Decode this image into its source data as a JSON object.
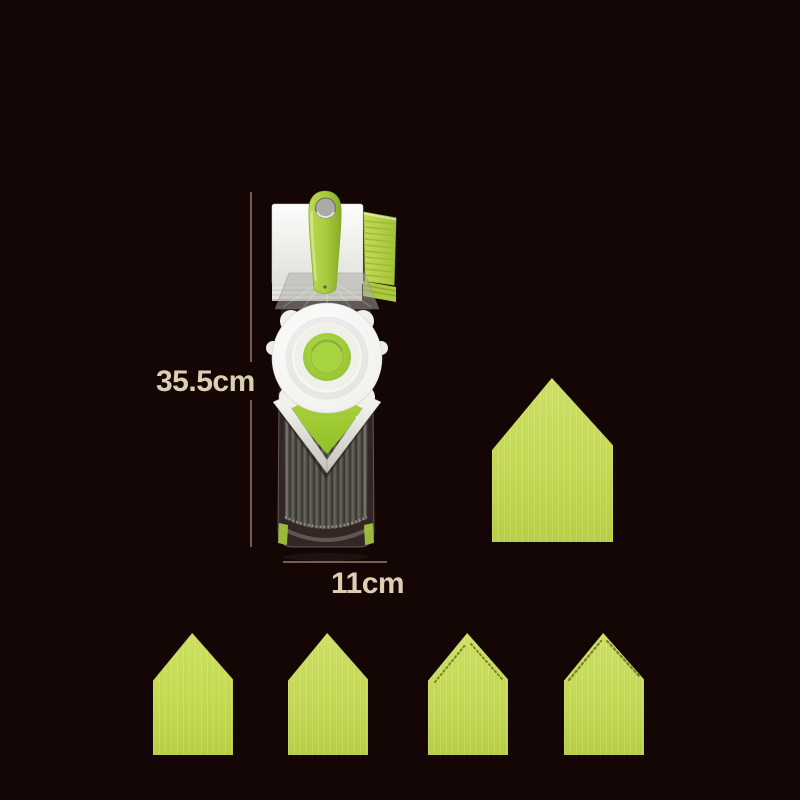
{
  "background_color": "#150606",
  "annotations": {
    "height_label": "35.5cm",
    "width_label": "11cm",
    "text_color": "#dccfb1",
    "line_color": "rgba(200,187,160,0.5)"
  },
  "product": {
    "item": "mandoline-vegetable-slicer",
    "palette": {
      "handle_green": "#a9cc3e",
      "insert_lime": "#c5d952",
      "white_plastic": "#f2f2ee",
      "deck_gray": "#53514a"
    }
  },
  "blade_inserts": {
    "large": {
      "style": "straight"
    },
    "row": [
      {
        "style": "straight"
      },
      {
        "style": "straight"
      },
      {
        "style": "serrated"
      },
      {
        "style": "serrated"
      }
    ]
  }
}
